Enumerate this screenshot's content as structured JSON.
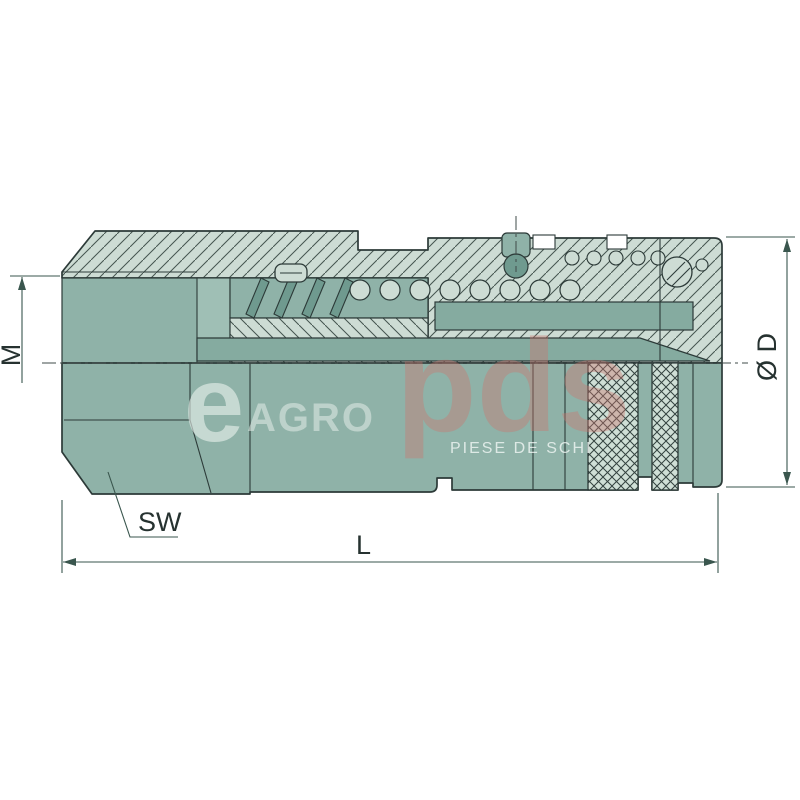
{
  "drawing": {
    "type": "technical-cross-section",
    "subject": "hydraulic quick-release coupling, female half-section view",
    "dimension_labels": {
      "thread_size": "M",
      "outer_diameter": "Ø D",
      "wrench_size": "SW",
      "overall_length": "L"
    }
  },
  "watermark": {
    "logo_e": "e",
    "logo_agro": "AGRO",
    "logo_pds": "pds",
    "tagline": "PIESE DE SCHI"
  },
  "colors": {
    "background": "#ffffff",
    "body_fill": "#8fb2a8",
    "body_fill_light": "#9fbfb5",
    "internal_fill": "#85aba0",
    "coil_fill": "#6f9a8f",
    "section_fill": "#cddcd4",
    "knurl_fill": "#cfdfd6",
    "line": "#2c3a38",
    "dimension_line": "#3a564e",
    "dimension_text": "#263230",
    "watermark_white": "#e9f1ec",
    "watermark_pink": "#ca766f"
  }
}
